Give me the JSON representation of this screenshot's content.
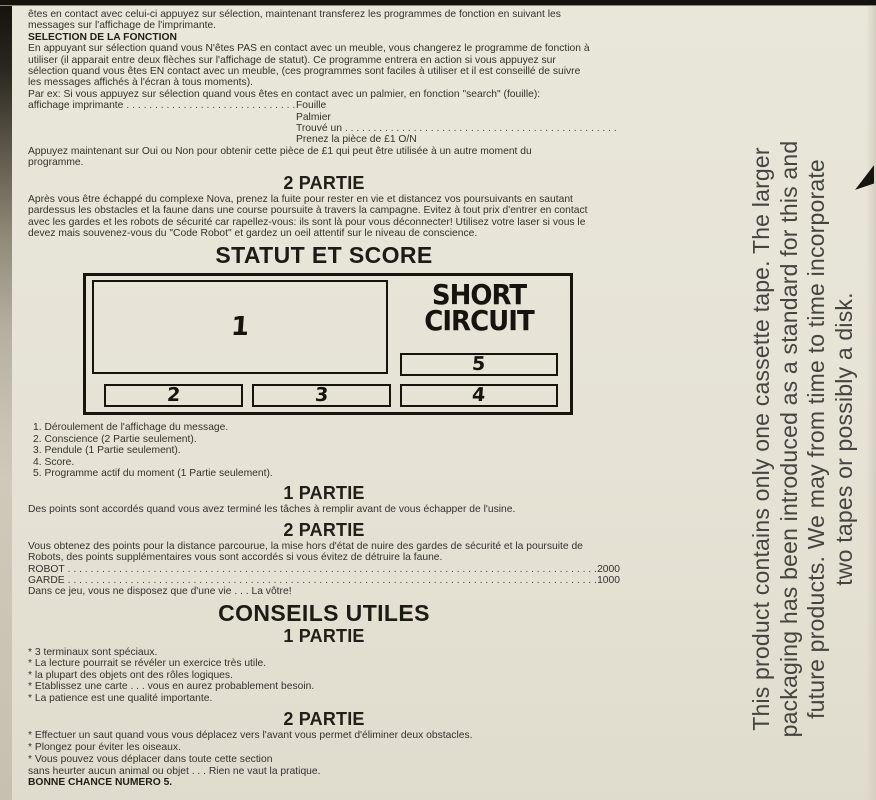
{
  "intro": {
    "lines": [
      "êtes en contact avec celui-ci appuyez sur sélection, maintenant transferez les programmes de fonction en suivant les",
      "messages sur l'affichage de l'imprimante."
    ]
  },
  "selection": {
    "heading": "SELECTION DE LA FONCTION",
    "body": [
      "En appuyant sur sélection quand vous N'êtes PAS en contact avec un meuble, vous changerez le programme de fonction à",
      "utiliser (il apparait entre deux flèches sur l'affichage de statut). Ce programme entrera en action si vous appuyez sur",
      "sélection quand vous êtes EN contact avec un meuble, (ces programmes sont faciles à utiliser et il est conseillé de suivre",
      "les messages affichés à l'écran à tous moments)."
    ],
    "par_ex": "Par ex: Si vous appuyez sur sélection quand vous êtes en contact avec un palmier, en fonction \"search\" (fouille):",
    "printer_label": "affichage imprimante",
    "printer_dots": ". . . . . . . . . . . . . . . . . . . . . . . . . . . . . . . . . . . . . . . .",
    "outputs": [
      "Fouille",
      "Palmier",
      "Trouvé un",
      "Prenez la pièce de £1 O/N"
    ],
    "trouve_dots": ". . . . . . . . . . . . . . . . . . . . . . . . . . . . . . . . . . . . . . . . . . . . . . . . . . . . . . . . . . . .",
    "after": [
      "Appuyez maintenant sur Oui ou Non pour obtenir cette pièce de £1 qui peut être utilisée à un autre moment du",
      "programme."
    ]
  },
  "part2": {
    "heading": "2 PARTIE",
    "body": [
      "Après vous être échappé du complexe Nova, prenez la fuite pour rester en vie et distancez vos poursuivants en sautant",
      "pardessus les obstacles et la faune dans une course poursuite à travers la campagne. Evitez à tout prix d'entrer en contact",
      "avec les gardes et les robots de sécurité car rapellez-vous: ils sont là pour vous déconnecter! Utilisez votre laser si vous le",
      "devez mais souvenez-vous du \"Code Robot\" et gardez un oeil attentif sur le niveau de conscience."
    ]
  },
  "status": {
    "heading": "STATUT ET SCORE",
    "logo_line1": "SHORT",
    "logo_line2": "CIRCUIT",
    "boxes": {
      "b1": "1",
      "b2": "2",
      "b3": "3",
      "b4": "4",
      "b5": "5"
    },
    "legend": [
      "1. Déroulement de l'affichage du message.",
      "2. Conscience (2 Partie seulement).",
      "3. Pendule (1 Partie seulement).",
      "4. Score.",
      "5. Programme actif du moment (1 Partie seulement)."
    ]
  },
  "part1_score": {
    "heading": "1 PARTIE",
    "body": "Des points sont accordés quand vous avez terminé les tâches à remplir avant de vous échapper de l'usine."
  },
  "part2_score": {
    "heading": "2 PARTIE",
    "body": [
      "Vous obtenez des points pour la distance parcourue, la mise hors d'état de nuire des gardes de sécurité et la poursuite de",
      "Robots, des points supplémentaires vous sont accordés si vous évitez de détruire la faune."
    ],
    "rows": [
      {
        "label": "ROBOT",
        "dots": ". . . . . . . . . . . . . . . . . . . . . . . . . . . . . . . . . . . . . . . . . . . . . . . . . . . . . . . . . . . . . . . . . . . . . . . . . . . . . . . . . . . . . . . . . . . . . . . . . . . . . . . . . . . . . . . .",
        "value": "2000"
      },
      {
        "label": "GARDE",
        "dots": ". . . . . . . . . . . . . . . . . . . . . . . . . . . . . . . . . . . . . . . . . . . . . . . . . . . . . . . . . . . . . . . . . . . . . . . . . . . . . . . . . . . . . . . . . . . . . . . . . . . . . . . . . . . . . . . .",
        "value": "1000"
      }
    ],
    "note": "Dans ce jeu, vous ne disposez que d'une vie . . . La vôtre!"
  },
  "conseils": {
    "heading": "CONSEILS UTILES",
    "part1_heading": "1 PARTIE",
    "part1_tips": [
      "* 3 terminaux sont spéciaux.",
      "* La lecture pourrait se révéler un exercice très utile.",
      "* la plupart des objets ont des rôles logiques.",
      "* Etablissez une carte . . . vous en aurez probablement besoin.",
      "* La patience est une qualité importante."
    ],
    "part2_heading": "2 PARTIE",
    "part2_tips": [
      "* Effectuer un saut quand vous vous déplacez vers l'avant vous permet d'éliminer deux obstacles.",
      "* Plongez pour éviter les oiseaux.",
      "* Vous pouvez vous déplacer dans toute cette section"
    ],
    "tail": [
      "sans heurter aucun animal ou objet . . . Rien ne vaut la pratique."
    ],
    "closing": "BONNE CHANCE NUMERO 5."
  },
  "margin_note": {
    "lines": [
      "This product contains only one cassette tape. The larger",
      "packaging has been introduced as a standard for this and",
      "future products. We may from time to time incorporate",
      "two tapes or possibly a disk."
    ]
  }
}
